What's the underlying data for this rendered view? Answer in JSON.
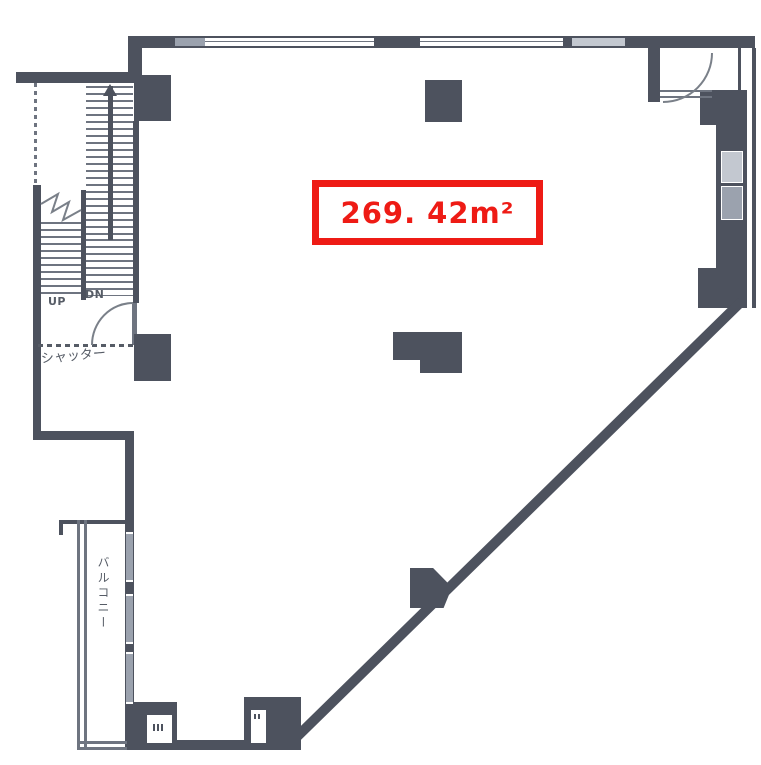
{
  "floor_plan": {
    "area_label": "269. 42m²",
    "stairs": {
      "up": "UP",
      "dn": "DN"
    },
    "shutter_label": "シャッター",
    "balcony_label": "バルコニー"
  },
  "colors": {
    "wall": "#4d525e",
    "wall_med": "#6e7480",
    "glass": "#c3c8d0",
    "glass_dim": "#9ba2ae",
    "label": "#565c66",
    "red": "#ee1b15",
    "bg": "#ffffff"
  }
}
